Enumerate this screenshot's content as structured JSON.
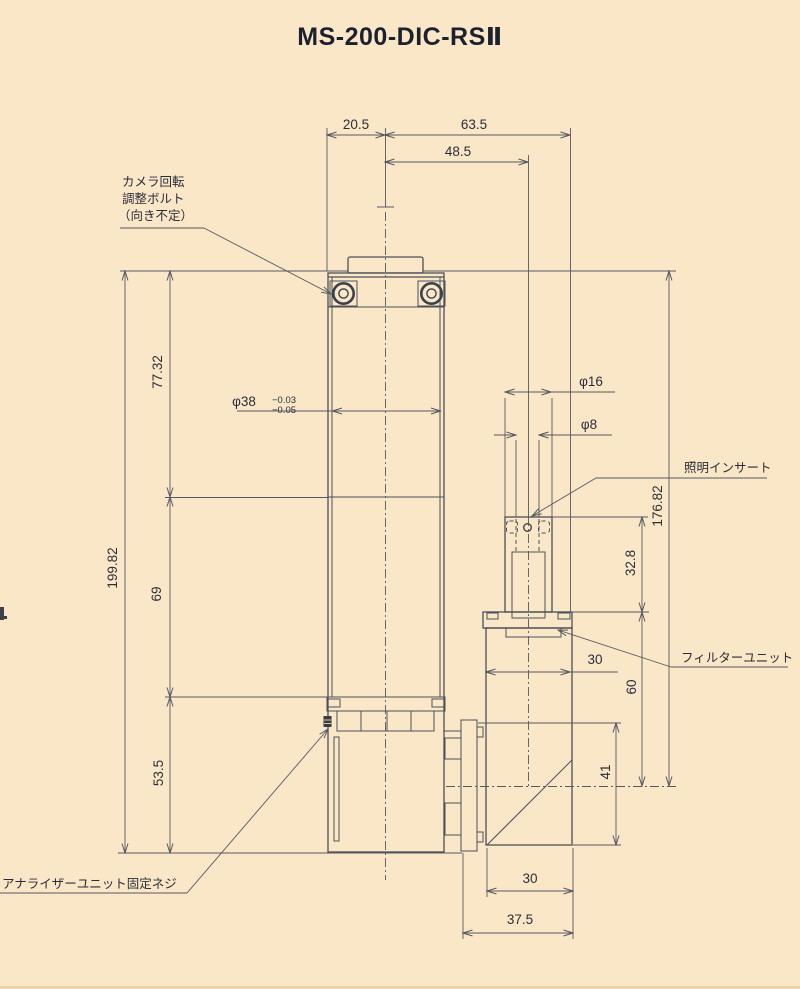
{
  "title": "MS-200-DIC-RSⅡ",
  "colors": {
    "background": "#fae7c7",
    "line": "#4c505a",
    "dimension_line": "#555963",
    "text": "#2a2e3a",
    "title_text": "#1c2130"
  },
  "annotations": {
    "camera_bolt_label": [
      "カメラ回転",
      "調整ボルト",
      "（向き不定）"
    ],
    "illumination_insert_label": "照明インサート",
    "filter_unit_label": "フィルターユニット",
    "analyzer_screw_label": "アナライザーユニット固定ネジ"
  },
  "dimensions": {
    "top_offset": "20.5",
    "top_span_right": "63.5",
    "top_span_inner": "48.5",
    "left_total": "199.82",
    "left_upper": "77.32",
    "left_mid": "69",
    "left_lower": "53.5",
    "body_dia": "φ38",
    "body_dia_tol_top": "−0.03",
    "body_dia_tol_bottom": "−0.05",
    "port_dia_outer": "φ16",
    "port_dia_inner": "φ8",
    "right_total": "176.82",
    "port_height": "32.8",
    "filter_top_width": "30",
    "axis_height": "60",
    "lower_box_height": "41",
    "bottom_width": "30",
    "bottom_total_width": "37.5"
  }
}
